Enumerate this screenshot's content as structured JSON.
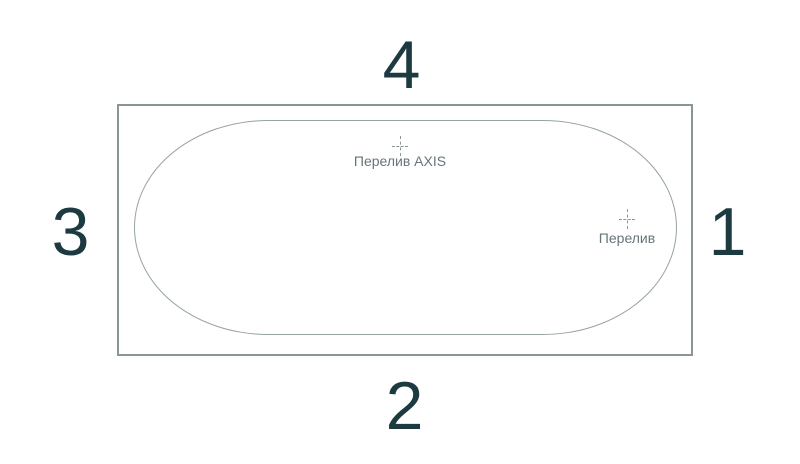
{
  "diagram": {
    "type": "bathtub-top-view-scheme",
    "side_numbers": {
      "top": "4",
      "bottom": "2",
      "left": "3",
      "right": "1"
    },
    "markers": {
      "overflow_axis": {
        "label": "Перелив AXIS"
      },
      "overflow": {
        "label": "Перелив"
      }
    },
    "colors": {
      "number_text": "#1c3a40",
      "marker_label": "#66757a",
      "outer_outline": "#8a9696",
      "inner_outline": "#97a3a3",
      "crosshair": "#8b9797",
      "background": "#ffffff"
    }
  }
}
